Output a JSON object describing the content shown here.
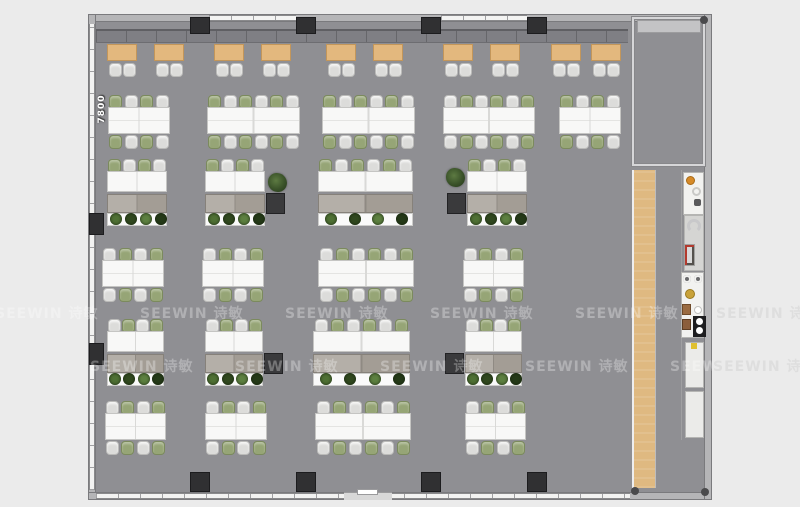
{
  "plan": {
    "x": 88,
    "y": 14,
    "w": 624,
    "h": 486,
    "floor_color": "#8f8f93"
  },
  "labels": {
    "top": [
      {
        "text": "3800",
        "cx": 144,
        "y": 31
      },
      {
        "text": "3500",
        "cx": 251,
        "y": 31
      },
      {
        "text": "4200",
        "cx": 349,
        "y": 31
      },
      {
        "text": "3500",
        "cx": 462,
        "y": 31
      }
    ],
    "left": {
      "text": "7800"
    }
  },
  "watermark": {
    "text": "SEEWIN 诗敏",
    "rows": [
      {
        "y": 303,
        "offset": -5
      },
      {
        "y": 356,
        "offset": 90
      }
    ],
    "spacing": 145,
    "outside": [
      {
        "x": 716,
        "y": 303
      },
      {
        "x": 713,
        "y": 356
      }
    ]
  },
  "structure": {
    "columns": {
      "top_x": [
        190,
        296,
        421,
        527
      ],
      "bottom_x": [
        190,
        296,
        421,
        527
      ],
      "left_y": [
        213,
        343
      ]
    },
    "windows": {
      "top_sections": [
        [
          209,
          296
        ],
        [
          441,
          527
        ]
      ],
      "bottom_span": [
        96,
        630
      ],
      "door": [
        344,
        392
      ]
    },
    "glass_room": {
      "x": 631,
      "y": 16,
      "w": 75,
      "h": 151,
      "credenza": {
        "x": 637,
        "y": 20,
        "w": 64,
        "h": 13
      }
    },
    "wood_strip": {
      "x": 632,
      "y": 170,
      "w": 24,
      "h": 318
    },
    "pantry_divider": {
      "x": 681,
      "y": 170,
      "h": 270
    },
    "corner_dots": [
      {
        "x": 631,
        "y": 487
      },
      {
        "x": 701,
        "y": 488
      },
      {
        "x": 700,
        "y": 16
      }
    ]
  },
  "furniture": {
    "banquette": {
      "x": 96,
      "y": 29,
      "w": 532,
      "h": 14
    },
    "booth_tables": {
      "y": 44,
      "w": 30,
      "h": 17,
      "chair_y": 63,
      "x_list": [
        107,
        154,
        214,
        261,
        326,
        373,
        443,
        490,
        551,
        591
      ]
    },
    "clusters": [
      {
        "x": 108,
        "y": 95,
        "w": 62,
        "seats": 4,
        "start": "g"
      },
      {
        "x": 207,
        "y": 95,
        "w": 93,
        "seats": 6,
        "start": "g"
      },
      {
        "x": 322,
        "y": 95,
        "w": 93,
        "seats": 6,
        "start": "g"
      },
      {
        "x": 443,
        "y": 95,
        "w": 92,
        "seats": 6,
        "start": "w"
      },
      {
        "x": 559,
        "y": 95,
        "w": 62,
        "seats": 4,
        "start": "g"
      },
      {
        "x": 102,
        "y": 248,
        "w": 62,
        "seats": 4,
        "start": "w"
      },
      {
        "x": 202,
        "y": 248,
        "w": 62,
        "seats": 4,
        "start": "w"
      },
      {
        "x": 318,
        "y": 248,
        "w": 96,
        "seats": 6,
        "start": "w"
      },
      {
        "x": 463,
        "y": 248,
        "w": 61,
        "seats": 4,
        "start": "w"
      },
      {
        "x": 105,
        "y": 401,
        "w": 61,
        "seats": 4,
        "start": "w"
      },
      {
        "x": 205,
        "y": 401,
        "w": 62,
        "seats": 4,
        "start": "w"
      },
      {
        "x": 315,
        "y": 401,
        "w": 96,
        "seats": 6,
        "start": "w"
      },
      {
        "x": 465,
        "y": 401,
        "w": 61,
        "seats": 4,
        "start": "w"
      }
    ],
    "bench_units": [
      {
        "x": 107,
        "y": 159,
        "w": 60,
        "seats": 4,
        "dark": null,
        "start": "g"
      },
      {
        "x": 205,
        "y": 159,
        "w": 60,
        "seats": 4,
        "dark": "right",
        "start": "g"
      },
      {
        "x": 318,
        "y": 159,
        "w": 95,
        "seats": 6,
        "dark": null,
        "start": "g"
      },
      {
        "x": 467,
        "y": 159,
        "w": 60,
        "seats": 4,
        "dark": "left",
        "start": "g"
      },
      {
        "x": 107,
        "y": 319,
        "w": 57,
        "seats": 4,
        "dark": null,
        "start": "w"
      },
      {
        "x": 205,
        "y": 319,
        "w": 58,
        "seats": 4,
        "dark": "right",
        "start": "w"
      },
      {
        "x": 313,
        "y": 319,
        "w": 97,
        "seats": 6,
        "dark": null,
        "start": "w"
      },
      {
        "x": 465,
        "y": 319,
        "w": 57,
        "seats": 4,
        "dark": "left",
        "start": "w"
      }
    ],
    "plants": [
      {
        "x": 268,
        "y": 173
      },
      {
        "x": 446,
        "y": 168
      }
    ],
    "plant_colors": [
      "#4f7134",
      "#31491f",
      "#5d8040",
      "#253a18"
    ],
    "pantry_blocks": [
      {
        "x": 683,
        "y": 172,
        "w": 21,
        "h": 43,
        "tone": "white",
        "icons": [
          "orange-dot",
          "ring",
          "speaker"
        ]
      },
      {
        "x": 684,
        "y": 215,
        "w": 20,
        "h": 56,
        "tone": "gray",
        "icons": [
          "c-shape",
          "machine"
        ]
      },
      {
        "x": 681,
        "y": 272,
        "w": 23,
        "h": 66,
        "tone": "white",
        "icons": [
          "fan",
          "fan2",
          "gold-dot",
          "photo",
          "cup",
          "photo2",
          "stove"
        ]
      },
      {
        "x": 685,
        "y": 342,
        "w": 19,
        "h": 46,
        "tone": "light",
        "icons": [
          "warn"
        ]
      },
      {
        "x": 685,
        "y": 391,
        "w": 19,
        "h": 47,
        "tone": "light",
        "icons": []
      }
    ],
    "accent_colors": {
      "orange": "#d68a28",
      "gold": "#c9a23a",
      "warn_yellow": "#e0c030"
    }
  }
}
